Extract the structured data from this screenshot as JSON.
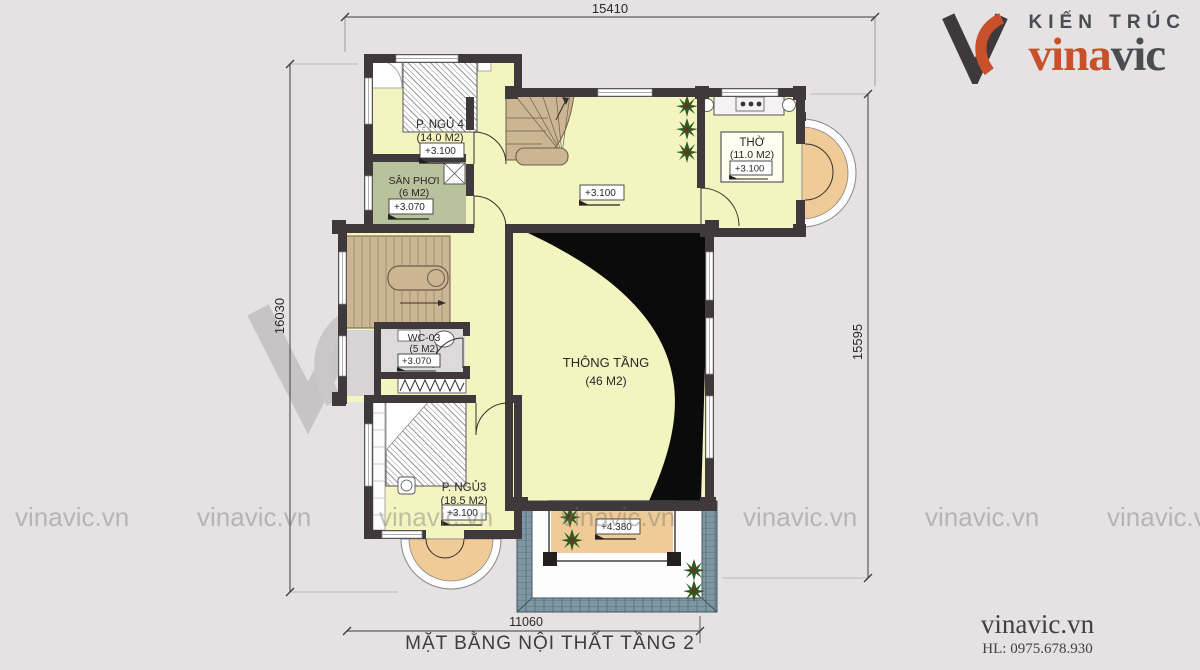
{
  "logo": {
    "tagline": "KIẾN TRÚC",
    "name_accent": "vina",
    "name_rest": "vic",
    "accent_color": "#c8502b",
    "dark_color": "#4a4c50"
  },
  "title": "MẶT BẰNG NỘI THẤT TẦNG 2",
  "footer": {
    "website": "vinavic.vn",
    "hotline": "HL: 0975.678.930"
  },
  "watermark": {
    "text": "vinavic.vn",
    "brand": "vinavic",
    "subtext": "DESIGNER & BUILDING"
  },
  "dimensions": {
    "top": "15410",
    "left": "16030",
    "right": "15595",
    "bottom": "11060"
  },
  "rooms": {
    "bedroom4": {
      "name": "P. NGỦ 4",
      "area": "(14.0 M2)",
      "level": "+3.100"
    },
    "san_phoi": {
      "name": "SÂN PHƠI",
      "area": "(6 M2)",
      "level": "+3.070"
    },
    "tho": {
      "name": "THỜ",
      "area": "(11.0 M2)",
      "level": "+3.100"
    },
    "thong_tang": {
      "name": "THÔNG TẦNG",
      "area": "(46 M2)"
    },
    "wc": {
      "name": "WC-03",
      "area": "(5 M2)",
      "level": "+3.070"
    },
    "bedroom3": {
      "name": "P. NGỦ3",
      "area": "(18.5 M2)",
      "level": "+3.100"
    }
  },
  "levels": {
    "hall": "+3.100",
    "terrace": "+4.380"
  }
}
